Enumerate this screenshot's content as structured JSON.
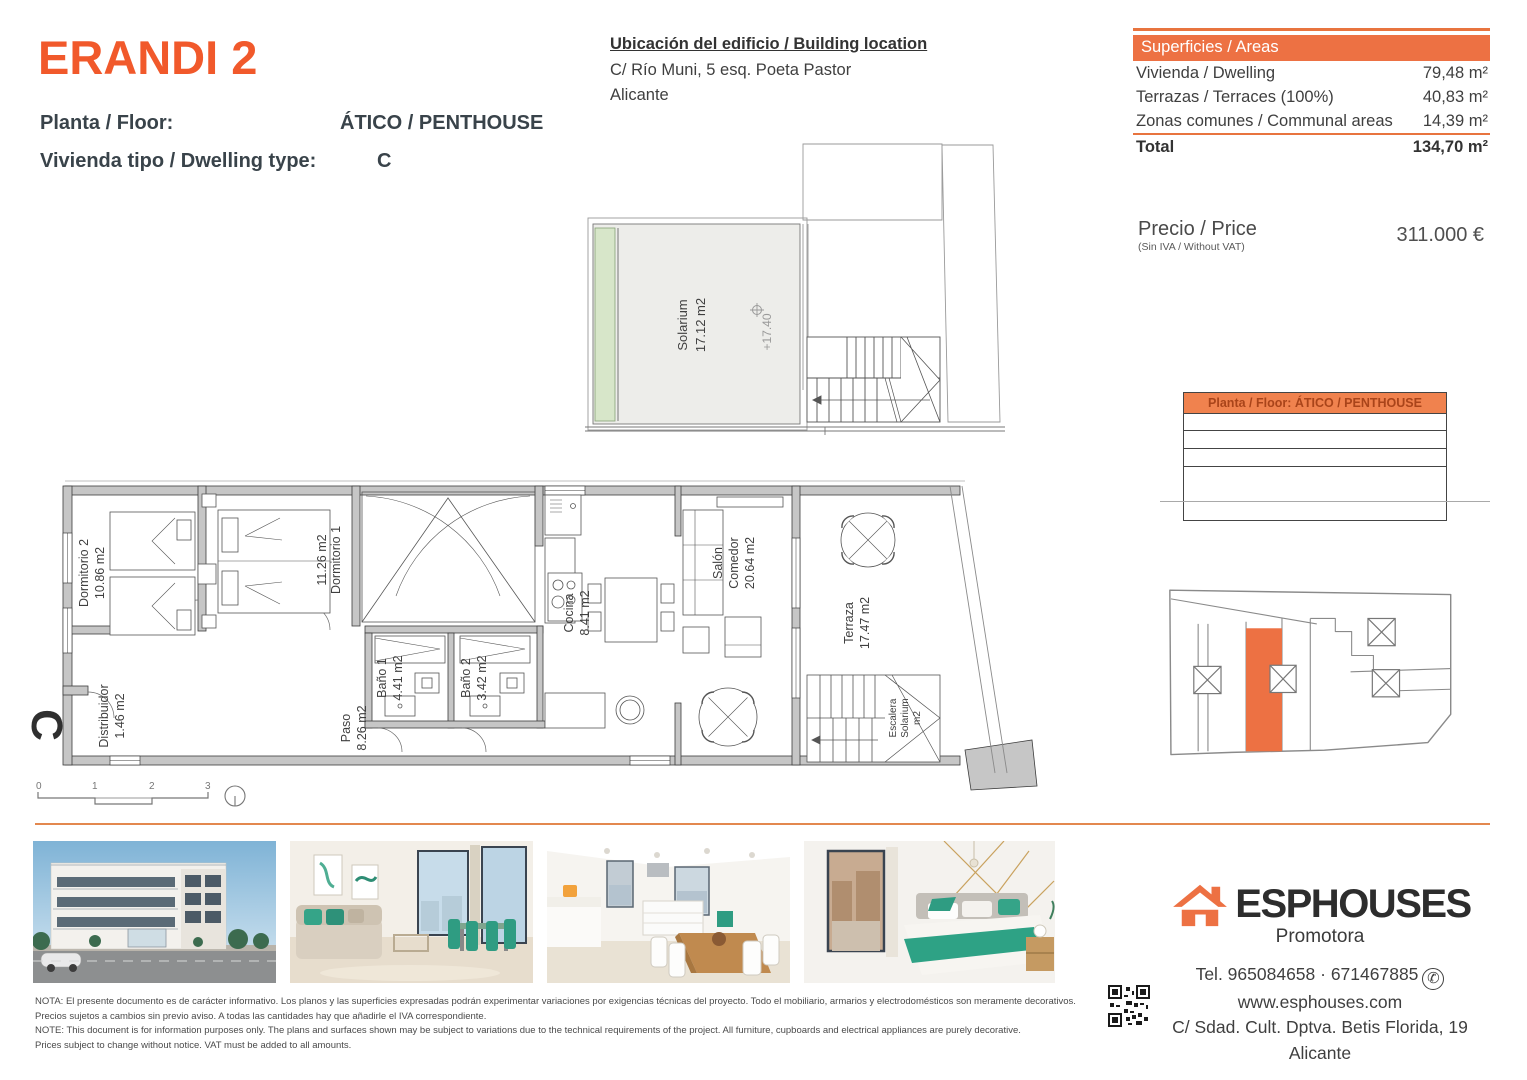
{
  "header": {
    "title": "ERANDI 2",
    "floor_label": "Planta / Floor:",
    "floor_value": "ÁTICO / PENTHOUSE",
    "type_label": "Vivienda tipo / Dwelling type:",
    "type_value": "C"
  },
  "location": {
    "heading": "Ubicación del edificio / Building location",
    "line1": "C/ Río Muni, 5 esq. Poeta Pastor",
    "line2": "Alicante"
  },
  "areas": {
    "header": "Superficies / Areas",
    "rows": [
      {
        "label": "Vivienda / Dwelling",
        "value": "79,48 m²"
      },
      {
        "label": "Terrazas / Terraces (100%)",
        "value": "40,83 m²"
      },
      {
        "label": "Zonas comunes / Communal areas",
        "value": "14,39 m²"
      }
    ],
    "total_label": "Total",
    "total_value": "134,70 m²"
  },
  "price": {
    "label": "Precio / Price",
    "sublabel": "(Sin IVA / Without VAT)",
    "value": "311.000 €"
  },
  "floor_table": {
    "header": "Planta / Floor: ÁTICO / PENTHOUSE"
  },
  "solarium": {
    "label": "Solarium",
    "area": "17.12 m2",
    "level": "+17.40"
  },
  "plan": {
    "letter": "C",
    "rooms": [
      {
        "name": "Dormitorio 2",
        "area": "10.86 m2"
      },
      {
        "name": "Dormitorio 1",
        "area": "11.26 m2"
      },
      {
        "name": "Distribuidor",
        "area": "1.46 m2"
      },
      {
        "name": "Paso",
        "area": "8.26 m2"
      },
      {
        "name": "Baño 1",
        "area": "4.41 m2"
      },
      {
        "name": "Baño 2",
        "area": "3.42 m2"
      },
      {
        "name": "Cocina",
        "area": "8.41 m2"
      },
      {
        "name": "Salón",
        "name2": "Comedor",
        "area": "20.64 m2"
      },
      {
        "name": "Terraza",
        "area": "17.47 m2"
      },
      {
        "name": "Escalera",
        "name2": "Solarium",
        "area": "m2"
      }
    ],
    "scale_ticks": [
      "0",
      "1",
      "2",
      "3"
    ]
  },
  "footer": {
    "disclaimer": [
      "NOTA: El presente documento es de carácter informativo. Los planos y las superficies expresadas podrán experimentar variaciones por exigencias técnicas del proyecto. Todo el mobiliario, armarios y electrodomésticos son meramente decorativos.",
      "Precios sujetos a cambios sin previo aviso. A todas las cantidades hay que añadirle el IVA correspondiente.",
      "NOTE: This document is for information purposes only. The plans and surfaces shown may be subject to variations due to the technical requirements of the project. All furniture, cupboards and electrical appliances are purely decorative.",
      "Prices subject to change without notice. VAT must be added to all amounts."
    ]
  },
  "brand": {
    "name": "ESPHOUSES",
    "subtitle": "Promotora",
    "phone": "Tel. 965084658 · 671467885",
    "web": "www.esphouses.com",
    "address1": "C/ Sdad. Cult. Dptva. Betis Florida, 19",
    "address2": "Alicante"
  },
  "colors": {
    "accent": "#ED7143",
    "title_orange": "#F1592B",
    "highlight_unit": "#ED7143"
  }
}
